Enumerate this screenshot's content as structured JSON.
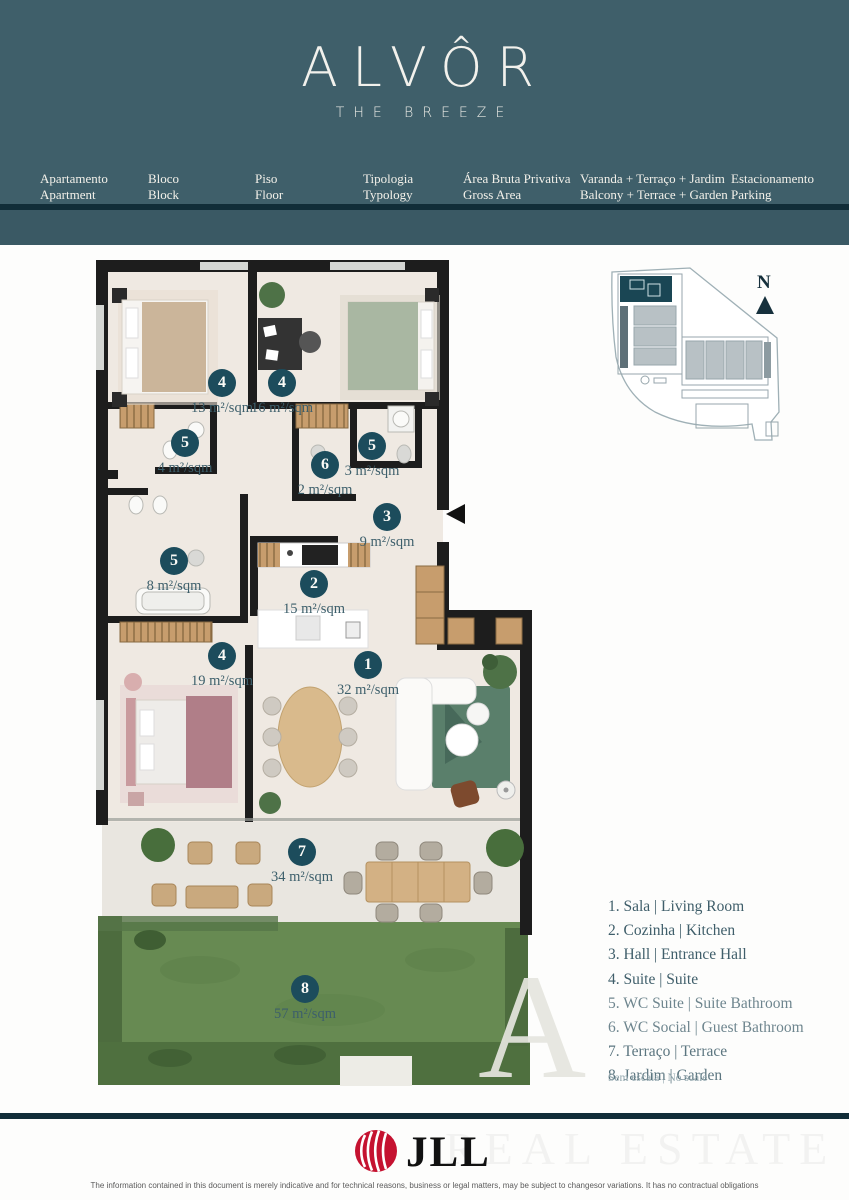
{
  "brand": {
    "name": "ALVÔR",
    "tagline": "THE BREEZE"
  },
  "header": {
    "columns": [
      {
        "pt": "Apartamento",
        "en": "Apartment"
      },
      {
        "pt": "Bloco",
        "en": "Block"
      },
      {
        "pt": "Piso",
        "en": "Floor"
      },
      {
        "pt": "Tipologia",
        "en": "Typology"
      },
      {
        "pt": "Área Bruta Privativa",
        "en": "Gross Area"
      },
      {
        "pt": "Varanda + Terraço + Jardim",
        "en": "Balcony + Terrace + Garden"
      },
      {
        "pt": "Estacionamento",
        "en": "Parking"
      }
    ]
  },
  "floorplan": {
    "badges": [
      {
        "number": "4",
        "area": "13 m²/sqm"
      },
      {
        "number": "4",
        "area": "16 m²/sqm"
      },
      {
        "number": "5",
        "area": "4 m²/sqm"
      },
      {
        "number": "6",
        "area": "2 m²/sqm"
      },
      {
        "number": "5",
        "area": "3 m²/sqm"
      },
      {
        "number": "3",
        "area": "9 m²/sqm"
      },
      {
        "number": "5",
        "area": "8 m²/sqm"
      },
      {
        "number": "2",
        "area": "15 m²/sqm"
      },
      {
        "number": "4",
        "area": "19 m²/sqm"
      },
      {
        "number": "1",
        "area": "32 m²/sqm"
      },
      {
        "number": "7",
        "area": "34 m²/sqm"
      },
      {
        "number": "8",
        "area": "57 m²/sqm"
      }
    ],
    "compass_label": "N"
  },
  "legend": {
    "items": [
      "1. Sala | Living Room",
      "2. Cozinha | Kitchen",
      "3. Hall | Entrance Hall",
      "4. Suite | Suite",
      "5. WC Suite | Suite Bathroom",
      "6. WC Social | Guest Bathroom",
      "7. Terraço | Terrace",
      "8. Jardim | Garden"
    ],
    "scale_note": "Sem escala | No scale"
  },
  "footer": {
    "logo_text": "JLL",
    "disclaimer": "The information contained in this document is merely indicative and for technical reasons, business or legal matters, may be subject to changesor variations. It has no contractual obligations"
  },
  "watermark": {
    "letter": "A",
    "text": "REAL ESTATE"
  },
  "colors": {
    "header_teal": "#3F5F6A",
    "header_band": "#3A5964",
    "divider_navy": "#112D38",
    "badge_teal": "#1C4C5C",
    "accent_text": "#3D5F6B",
    "wall_black": "#1D1D1D",
    "floor_beige": "#EFE9E2",
    "terrace_grey": "#E9E6E0",
    "grass_green": "#678A52",
    "hedge_green": "#4D6C3E",
    "jll_red": "#C51230"
  }
}
